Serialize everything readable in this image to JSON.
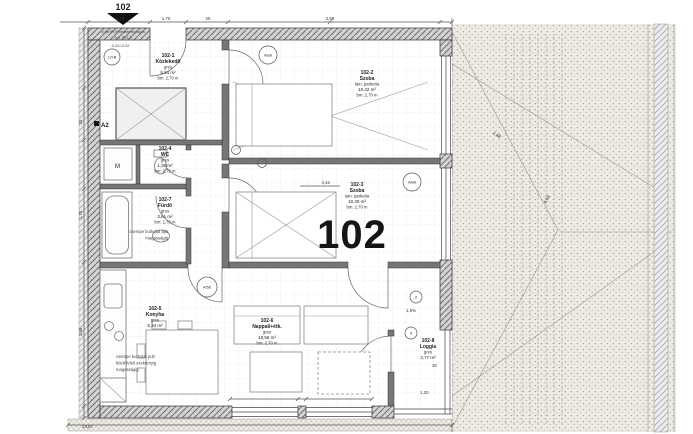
{
  "header": {
    "unit": "102",
    "note1": "3 db PT/PVhvlemezrag a",
    "note2": "a.a. 201,3",
    "level": "-0,02/-0,02"
  },
  "plan": {
    "big_label": "102"
  },
  "rooms": [
    {
      "num": "102-1",
      "name": "Közlekedő",
      "floor": "gres",
      "area": "5,94 m²",
      "height": "bm: 2,70 m"
    },
    {
      "num": "102-2",
      "name": "Szoba",
      "floor": "lam. parketta",
      "area": "10,42 m²",
      "height": "bm: 2,70 m"
    },
    {
      "num": "102-3",
      "name": "Szoba",
      "floor": "lam. parketta",
      "area": "10,30 m²",
      "height": "bm: 2,70 m"
    },
    {
      "num": "102-4",
      "name": "WC",
      "floor": "gres",
      "area": "1,38 m²",
      "height": "bm: 2,70 m"
    },
    {
      "num": "102-5",
      "name": "Konyha",
      "floor": "gres",
      "area": "5,34 m²",
      "height": ""
    },
    {
      "num": "102-6",
      "name": "Nappali+étk.",
      "floor": "gres",
      "area": "18,58 m²",
      "height": "bm: 2,70 m"
    },
    {
      "num": "102-7",
      "name": "Fürdő",
      "floor": "gres",
      "area": "3,61 m²",
      "height": "bm: 2,70 m"
    },
    {
      "num": "102-8",
      "name": "Loggia",
      "floor": "gres",
      "area": "3,77 m²",
      "height": ""
    }
  ],
  "notes": {
    "bath_tile_1": "csempe burkolat ajtó",
    "bath_tile_2": "magasságig",
    "kitchen_tile_1": "csempe burkolat pult",
    "kitchen_tile_2": "felett felső szekrényig",
    "kitchen_tile_3": "magasságig"
  },
  "markers": {
    "lob": "LO:B",
    "aa9_top": "A/a9",
    "aa9_right": "A/a9",
    "a5b": "A/5b",
    "a2": "A2",
    "washer": "M",
    "c2": "2",
    "c9": "9"
  },
  "dimensions": {
    "d138": "1,38",
    "d170": "1,70",
    "d25": "25",
    "d298": "2,98",
    "d25l": "25",
    "d170l": "1,70",
    "d398": "3,98",
    "d442": "4,42",
    "slope": "1,5%",
    "d30": "30",
    "d120": "1,20",
    "d1487": "14,87",
    "d458": "4,58",
    "d248": "2,48"
  }
}
